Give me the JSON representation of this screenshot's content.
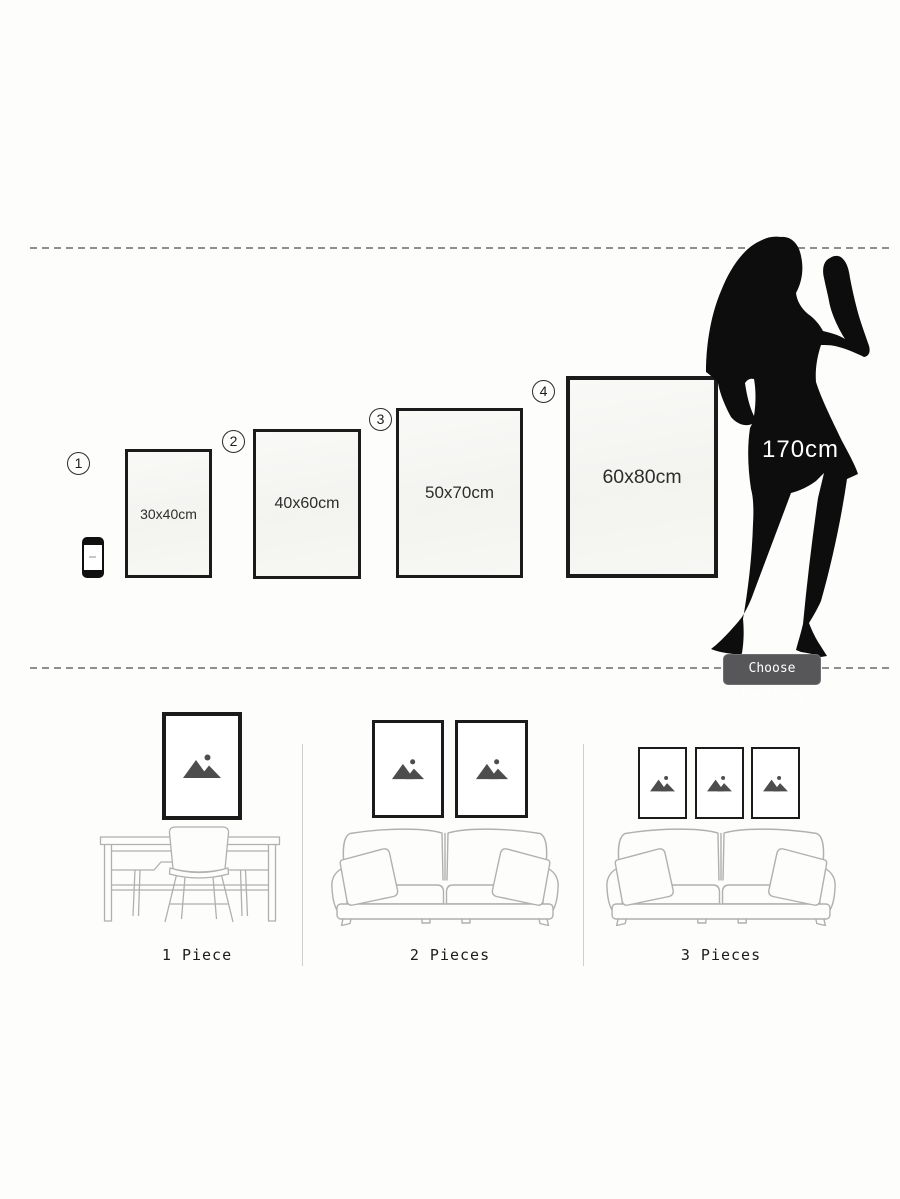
{
  "size_chart": {
    "options": [
      {
        "number": "1",
        "size_label": "30x40cm"
      },
      {
        "number": "2",
        "size_label": "40x60cm"
      },
      {
        "number": "3",
        "size_label": "50x70cm"
      },
      {
        "number": "4",
        "size_label": "60x80cm"
      }
    ],
    "reference_height_label": "170cm",
    "button_label": "Choose Painting"
  },
  "room_layouts": [
    {
      "label": "1 Piece"
    },
    {
      "label": "2 Pieces"
    },
    {
      "label": "3 Pieces"
    }
  ],
  "colors": {
    "background": "#fdfdfc",
    "frame_border": "#1b1b1b",
    "silhouette_black": "#0d0d0d",
    "button_bg": "#57575a",
    "dashed_line": "#8f8f8f",
    "furniture_line": "#b0b0b0",
    "placeholder_icon": "#4d4d4d"
  }
}
